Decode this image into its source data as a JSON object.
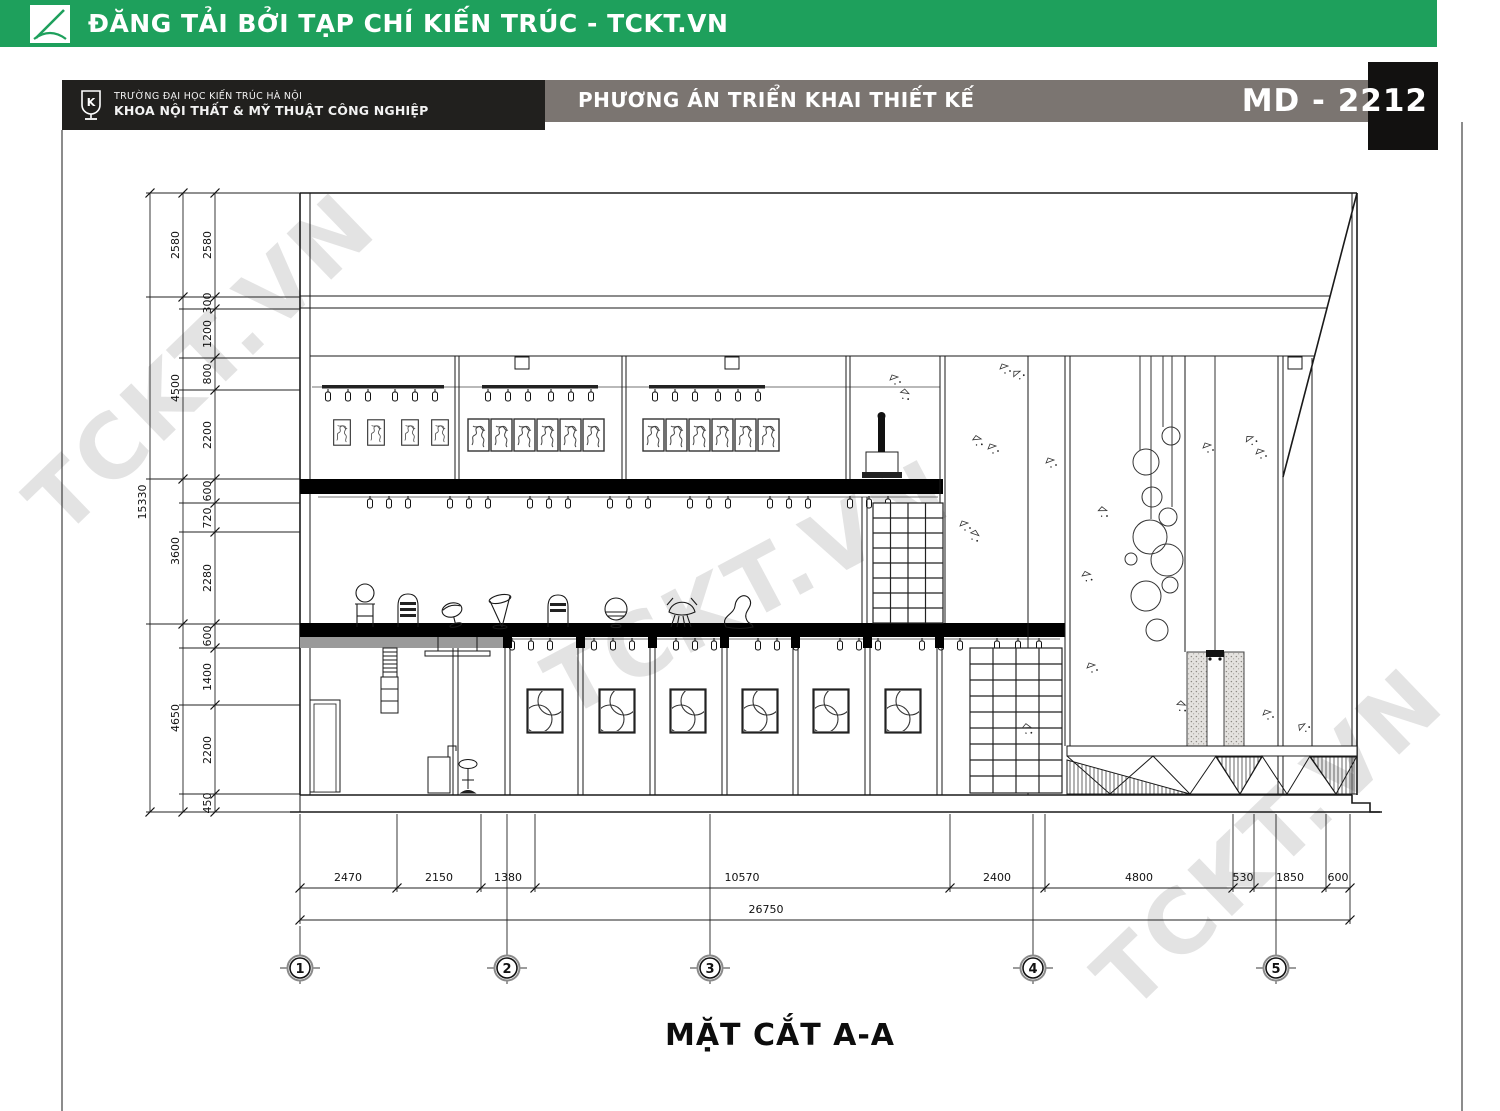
{
  "banner": {
    "text": "ĐĂNG TẢI BỞI TẠP CHÍ KIẾN TRÚC - TCKT.VN"
  },
  "titleblock": {
    "org_line1": "TRƯỜNG ĐẠI HỌC KIẾN TRÚC HÀ NỘI",
    "org_line2": "KHOA NỘI THẤT & MỸ THUẬT CÔNG NGHIỆP",
    "subtitle": "PHƯƠNG ÁN TRIỂN KHAI THIẾT KẾ",
    "code": "MD - 2212"
  },
  "watermark": {
    "text": "TCKT.VN"
  },
  "drawing": {
    "caption": "MẶT CẮT A-A",
    "grid_bubbles": [
      "1",
      "2",
      "3",
      "4",
      "5"
    ],
    "dims": {
      "left_total": "15330",
      "left_major": [
        "2580",
        "4500",
        "3600",
        "4650"
      ],
      "left_minor": [
        "2580",
        "300",
        "1200",
        "800",
        "2200",
        "600",
        "720",
        "2280",
        "600",
        "1400",
        "2200",
        "450"
      ],
      "bottom_segments": [
        "2470",
        "2150",
        "1380",
        "10570",
        "2400",
        "4800",
        "530",
        "1850",
        "600"
      ],
      "bottom_total": "26750"
    }
  },
  "colors": {
    "banner_green": "#1ea05c",
    "titlebar_gray": "#7b7571",
    "dark_box": "#21201e",
    "code_black": "#121110"
  }
}
